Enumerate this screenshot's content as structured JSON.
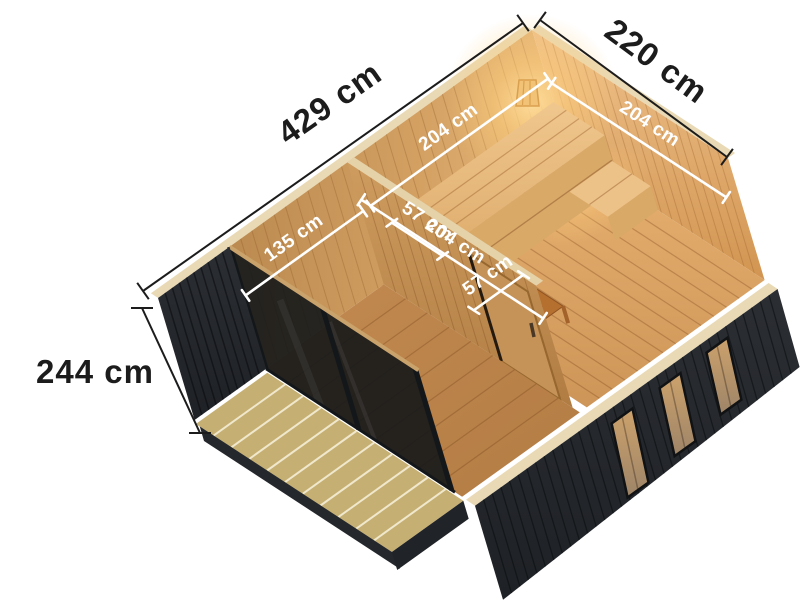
{
  "scene": {
    "subject": "sauna cabin cutaway isometric render with dimensions",
    "background": "#ffffff"
  },
  "dimensions": {
    "outer": {
      "length": {
        "label": "429 cm"
      },
      "width": {
        "label": "220 cm"
      },
      "height": {
        "label": "244 cm"
      }
    },
    "inner": {
      "sauna_depth": {
        "label": "204 cm"
      },
      "sauna_width": {
        "label": "204 cm"
      },
      "anteroom_width": {
        "label": "135 cm"
      },
      "anteroom_depth": {
        "label": "204 cm"
      },
      "bench_depth": {
        "label": "57 cm"
      },
      "heater_guard_width": {
        "label": "57 cm"
      }
    }
  },
  "colors": {
    "exterior_black": "#26292d",
    "interior_wood": "#d8a365",
    "floor_wood": "#c98f52",
    "deck_wood": "#c6af72",
    "heater_frame": "#b5702f",
    "lamp_glow": "#ffce7a",
    "dimension_outer_text": "#1c1c1c",
    "dimension_inner_text": "#ffffff"
  }
}
